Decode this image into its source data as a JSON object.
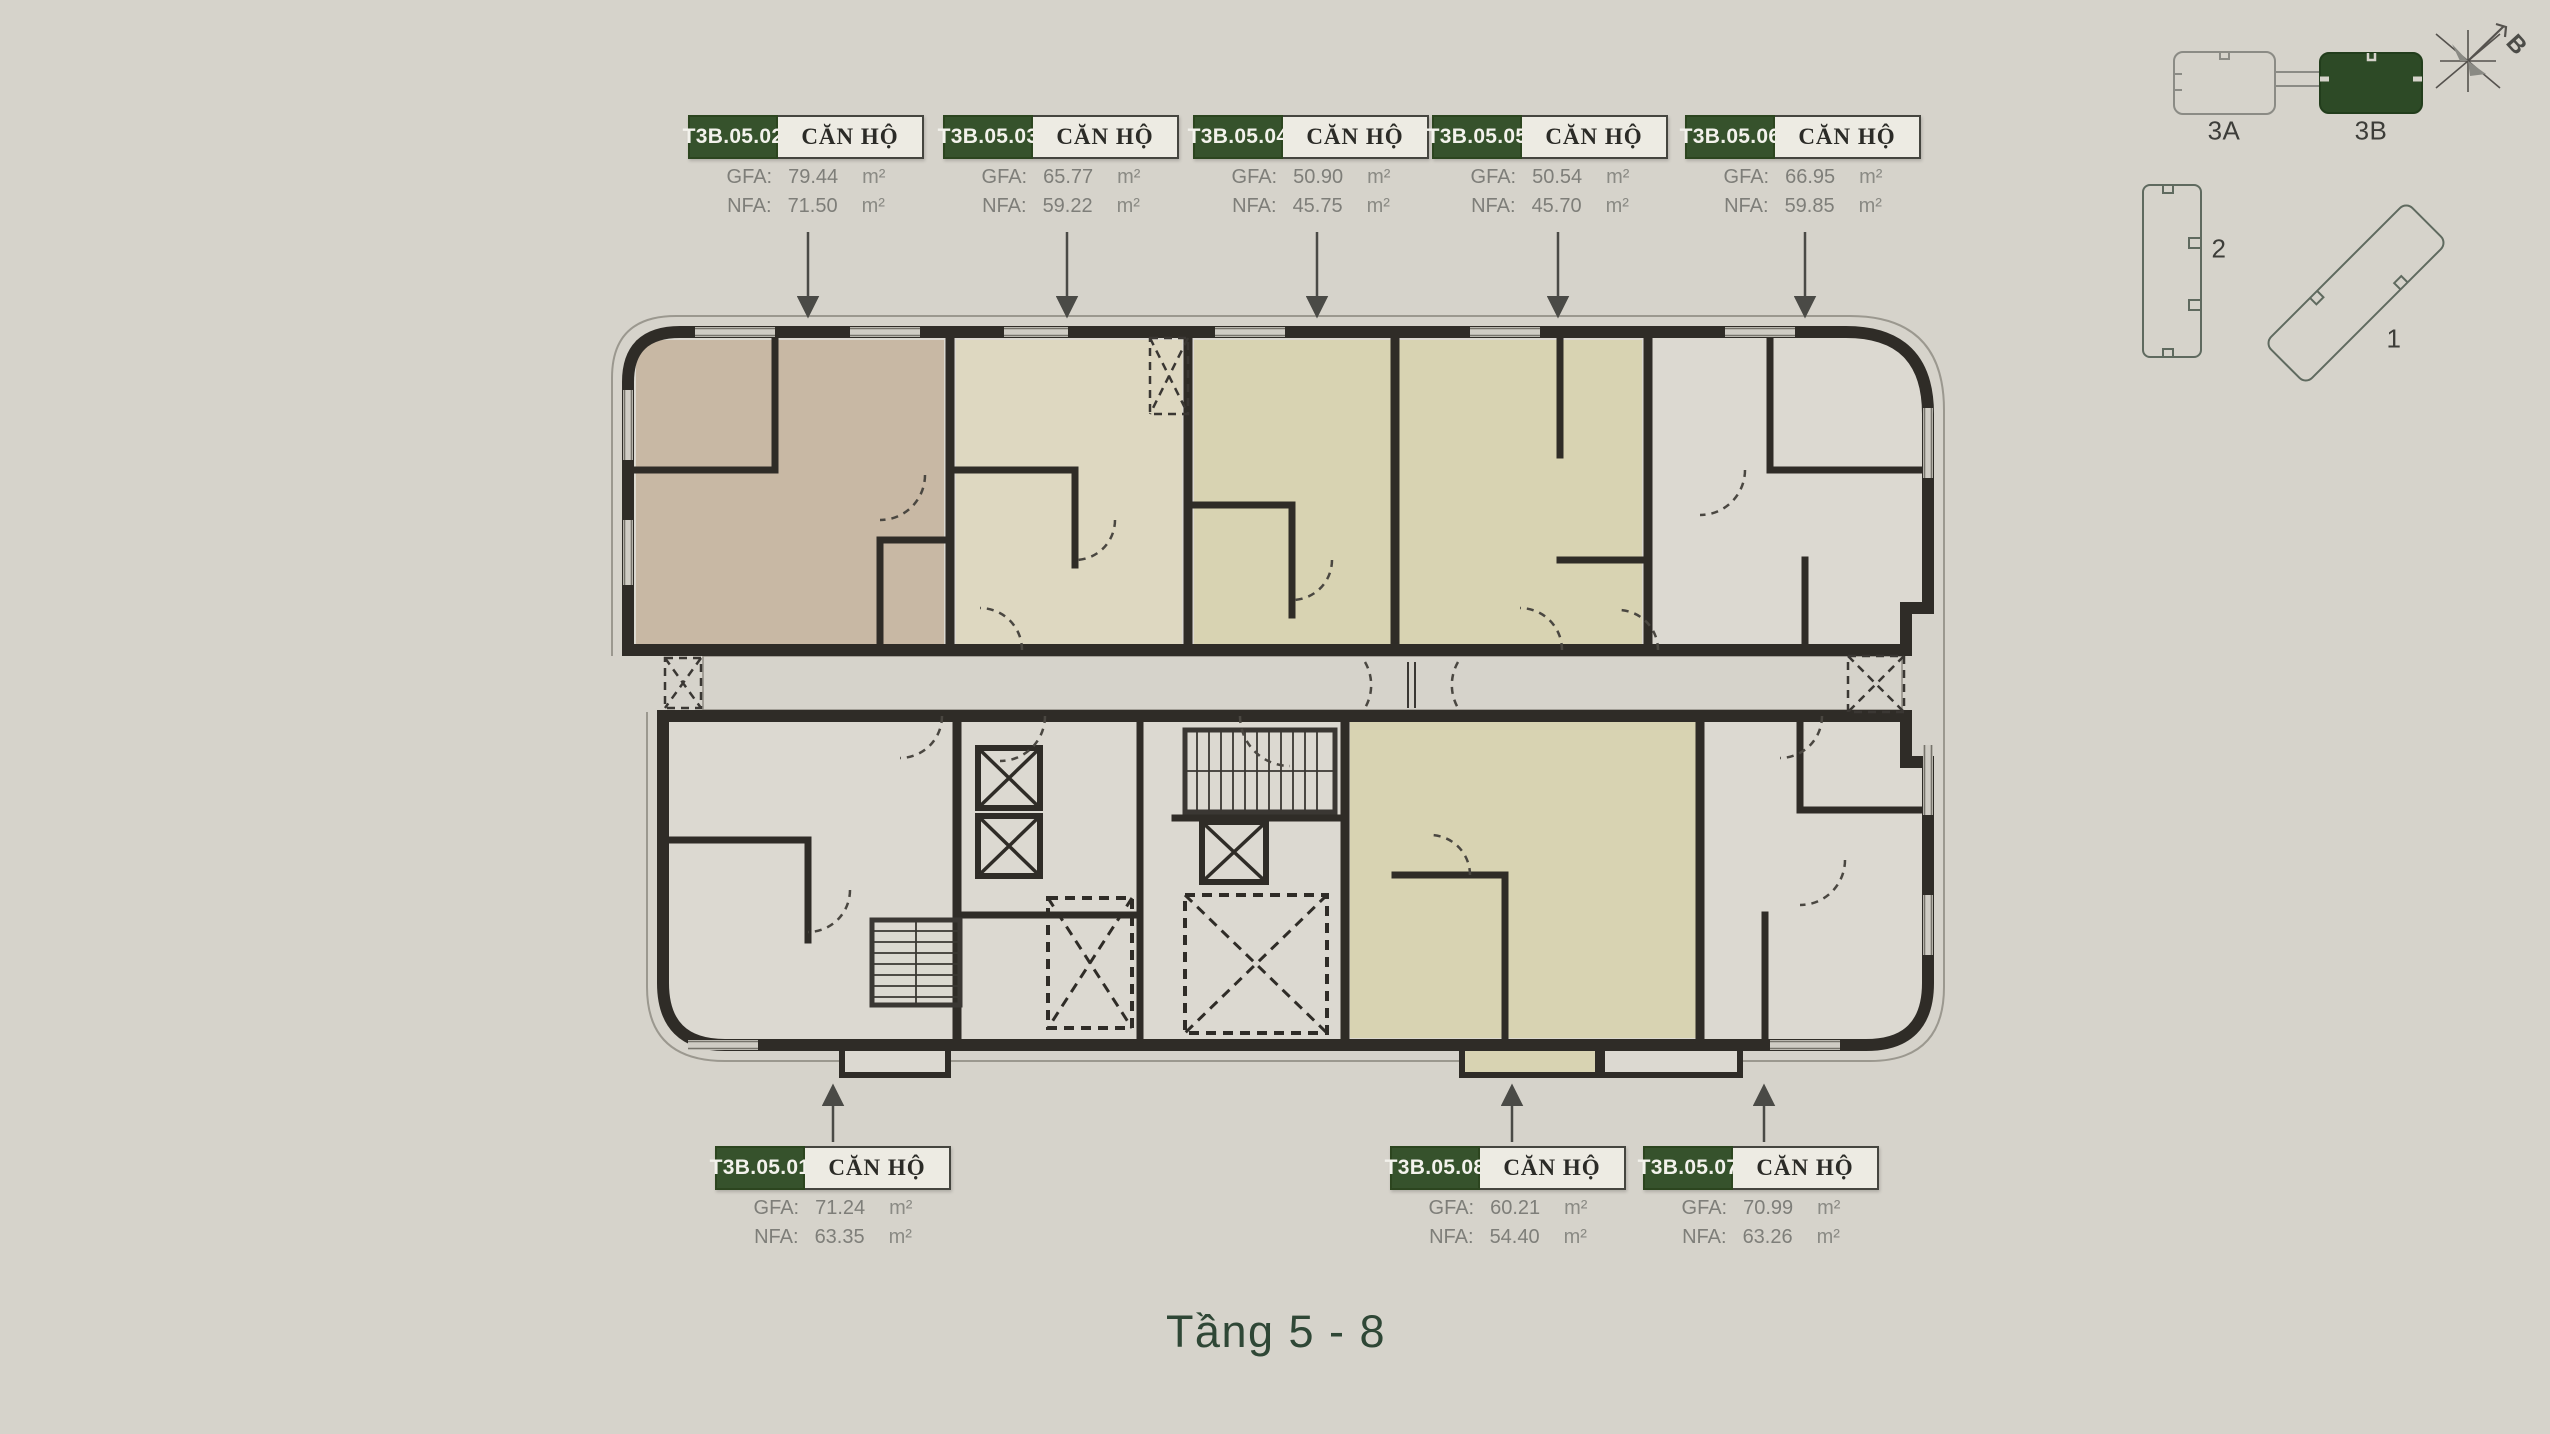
{
  "page": {
    "title": "Tầng 5 - 8"
  },
  "strings": {
    "unit_type": "CĂN HỘ",
    "gfa_label": "GFA:",
    "nfa_label": "NFA:",
    "area_unit": "m²"
  },
  "units": [
    {
      "id": "T3B.05.01",
      "gfa": "71.24",
      "nfa": "63.35"
    },
    {
      "id": "T3B.05.02",
      "gfa": "79.44",
      "nfa": "71.50"
    },
    {
      "id": "T3B.05.03",
      "gfa": "65.77",
      "nfa": "59.22"
    },
    {
      "id": "T3B.05.04",
      "gfa": "50.90",
      "nfa": "45.75"
    },
    {
      "id": "T3B.05.05",
      "gfa": "50.54",
      "nfa": "45.70"
    },
    {
      "id": "T3B.05.06",
      "gfa": "66.95",
      "nfa": "59.85"
    },
    {
      "id": "T3B.05.07",
      "gfa": "70.99",
      "nfa": "63.26"
    },
    {
      "id": "T3B.05.08",
      "gfa": "60.21",
      "nfa": "54.40"
    }
  ],
  "minimap": {
    "block_3a": "3A",
    "block_3b": "3B",
    "block_2": "2",
    "block_1": "1",
    "highlighted_block": "3B",
    "compass_label": "B"
  },
  "colors": {
    "background": "#d6d3cb",
    "plan_base": "#dcd9d1",
    "apartment_tan": "#c8b8a4",
    "apartment_cream": "#ded8c1",
    "apartment_yellow": "#d8d3b2",
    "wall": "#2f2c27",
    "label_green": "#36522c",
    "minimap_green": "#2d4a26",
    "title_green": "#2f4736"
  }
}
